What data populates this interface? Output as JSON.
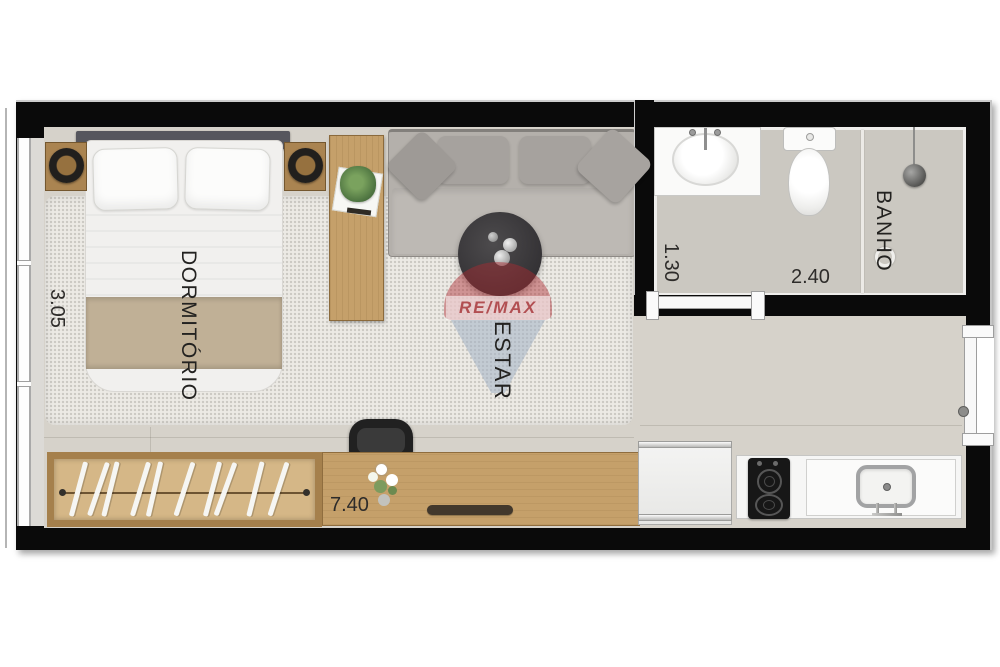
{
  "rooms": {
    "bedroom": {
      "label": "DORMITÓRIO"
    },
    "living": {
      "label": "ESTAR"
    },
    "bathroom": {
      "label": "BANHO"
    }
  },
  "dimensions": {
    "bedroom_width": "3.05",
    "bathroom_width": "1.30",
    "bathroom_length": "2.40",
    "total_length": "7.40"
  },
  "watermark": {
    "brand": "RE/MAX"
  },
  "colors": {
    "wall": "#0a0a0a",
    "floor": "#d6d2ca",
    "rug": "#eceae5",
    "bath_floor": "#cbc8c1",
    "wood": "#c5a06a",
    "wood_frame": "#a5804c",
    "sofa": "#b4b0ab",
    "blanket": "#c0b096",
    "remax_red_t": "rgba(172,42,48,0.45)",
    "remax_blue_t": "rgba(163,177,196,0.55)"
  }
}
